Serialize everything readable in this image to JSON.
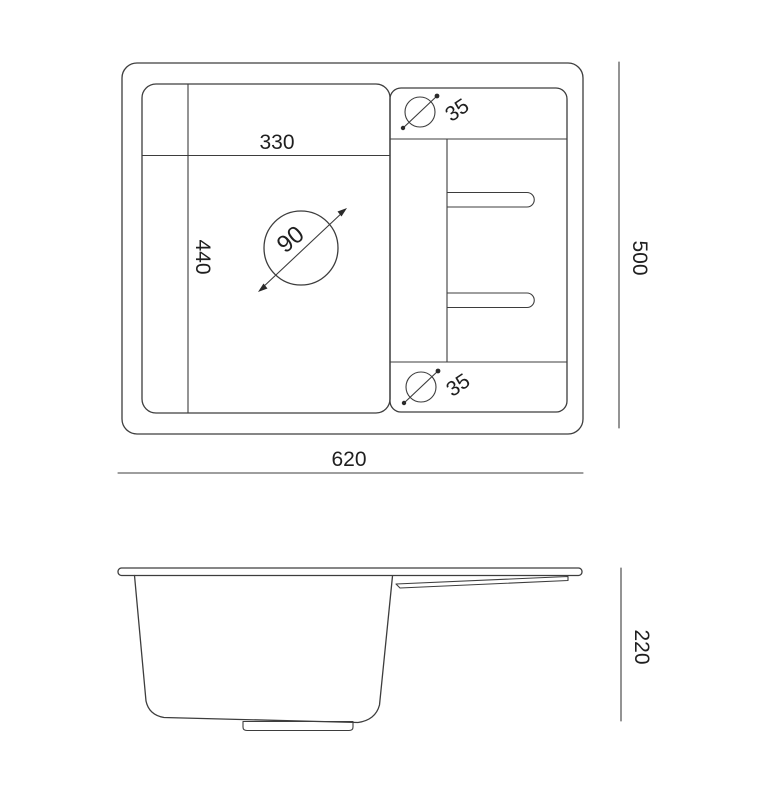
{
  "labels": {
    "bowl_width": "330",
    "bowl_length": "440",
    "drain_diameter": "90",
    "tap_hole_top": "35",
    "tap_hole_bottom": "35",
    "overall_width": "620",
    "overall_depth": "500",
    "overall_height": "220"
  },
  "colors": {
    "line": "#3d3d3d",
    "text": "#1f1f1f",
    "background": "#ffffff"
  }
}
